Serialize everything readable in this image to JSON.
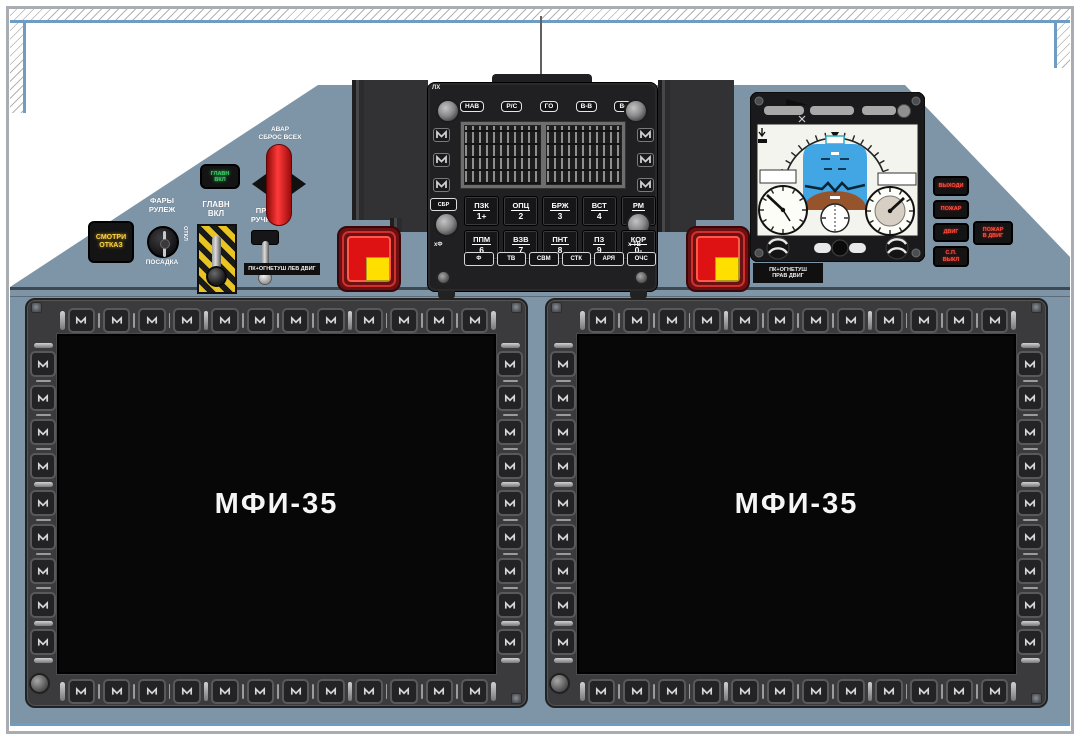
{
  "displays": {
    "left": {
      "label": "МФИ-35"
    },
    "right": {
      "label": "МФИ-35"
    },
    "bezel": {
      "top": "12",
      "bottom": "12",
      "left": "9",
      "right": "9"
    }
  },
  "left_cluster": {
    "master_caution": "СМОТРИ\nОТКАЗ",
    "lights_top": "ФАРЫ\nРУЛЕЖ",
    "lights_bottom": "ПОСАДКА",
    "lights_off": "ОТКЛ",
    "green_light": "ГЛАВН\nВКЛ",
    "master_switch": "ГЛАВН\nВКЛ",
    "manual_switch": "ПР\nРУЧН",
    "emergency_release": "АВАР\nСБРОС ВСЕХ"
  },
  "fire": {
    "left_label": "ПК+ОГНЕТУШ ЛЕВ ДВИГ",
    "right_label": "ПК+ОГНЕТУШ\nПРАВ ДВИГ"
  },
  "keypad": {
    "corner_label": "ЛХ",
    "modes": [
      "НАВ",
      "Р/С",
      "ГО",
      "В-В",
      "В-П"
    ],
    "clear": "СБР",
    "enter": "ВВД",
    "row1": [
      {
        "l": "ПЗК",
        "n": "1+"
      },
      {
        "l": "ОПЦ",
        "n": "2"
      },
      {
        "l": "БРЖ",
        "n": "3"
      },
      {
        "l": "ВСТ",
        "n": "4"
      },
      {
        "l": "РМ",
        "n": "5"
      }
    ],
    "row2": [
      {
        "l": "ППМ",
        "n": "6"
      },
      {
        "l": "ВЗВ",
        "n": "7"
      },
      {
        "l": "ПНТ",
        "n": "8"
      },
      {
        "l": "ПЗ",
        "n": "9"
      },
      {
        "l": "КОР",
        "n": "0-"
      }
    ],
    "funcs": [
      "Ф",
      "ТВ",
      "СВМ",
      "СТК",
      "АРЯ",
      "ОЧС"
    ],
    "label_left": "хФ",
    "label_right": "х ТВ"
  },
  "annunciators": {
    "stack": [
      {
        "text": "ВЫХОДИ"
      },
      {
        "text": "ПОЖАР"
      },
      {
        "text": "ДВИГ"
      },
      {
        "text": "С.П.\nВЫКЛ"
      }
    ],
    "side": {
      "text": "ПОЖАР\nВ ДВИГ"
    }
  },
  "colors": {
    "panel_blue_gray": "#7e95a8",
    "console_black": "#202022",
    "warning_red": "#de1212",
    "guard_yellow": "#ffdf00",
    "annunciator_yellow": "#ffd23f",
    "annunciator_green": "#3ed06a",
    "annunciator_red": "#ff5040",
    "border_blue": "#6f9cc2"
  }
}
